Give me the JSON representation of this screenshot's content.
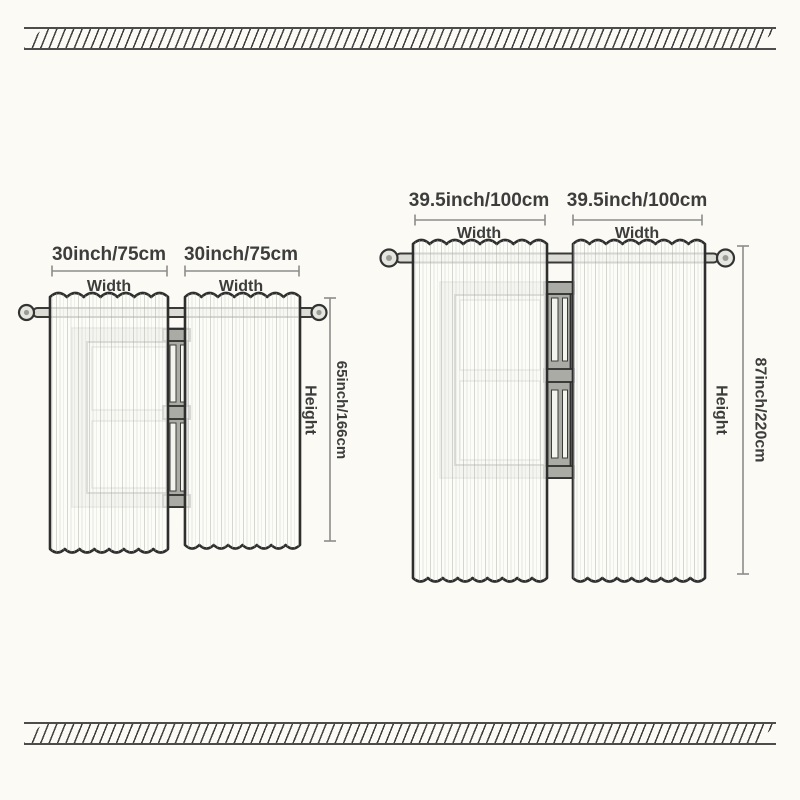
{
  "colors": {
    "background": "#fbfaf4",
    "outline": "#2e2e2e",
    "text": "#3d3d3d",
    "dimension": "#8c8c8c",
    "hatch": "#3f3f3f"
  },
  "sets": {
    "small": {
      "left_panel_width": "30inch/75cm",
      "right_panel_width": "30inch/75cm",
      "width_caption": "Width",
      "height_value": "65inch/166cm",
      "height_caption": "Height"
    },
    "large": {
      "left_panel_width": "39.5inch/100cm",
      "right_panel_width": "39.5inch/100cm",
      "width_caption": "Width",
      "height_value": "87inch/220cm",
      "height_caption": "Height"
    }
  }
}
